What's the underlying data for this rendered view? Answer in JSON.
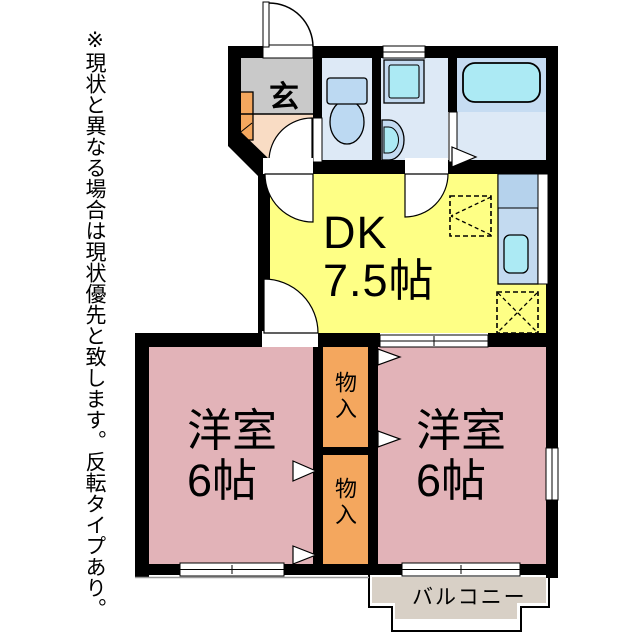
{
  "note": {
    "text": "※現状と異なる場合は現状優先と致します。反転タイプあり。"
  },
  "plan": {
    "entrance": {
      "label": "玄"
    },
    "dk": {
      "name": "DK",
      "size": "7.5帖"
    },
    "bedroom_left": {
      "name": "洋室",
      "size": "6帖"
    },
    "bedroom_right": {
      "name": "洋室",
      "size": "6帖"
    },
    "closet_top": {
      "label": "物入"
    },
    "closet_bottom": {
      "label": "物入"
    },
    "balcony": {
      "label": "バルコニー"
    }
  },
  "colors": {
    "wall": "#000000",
    "dk_floor": "#feff85",
    "bedroom_floor": "#e2b3b8",
    "closet_floor": "#f4a75e",
    "entrance_gray": "#c9c9c9",
    "hallway_peach": "#f9dcc4",
    "wet_area_floor": "#dde9f6",
    "bath_zone": "#c6dcf2",
    "fixture_blue": "#c3daf0",
    "fixture_cyan": "#aceaf4",
    "balcony_floor": "#d8d0c6"
  }
}
